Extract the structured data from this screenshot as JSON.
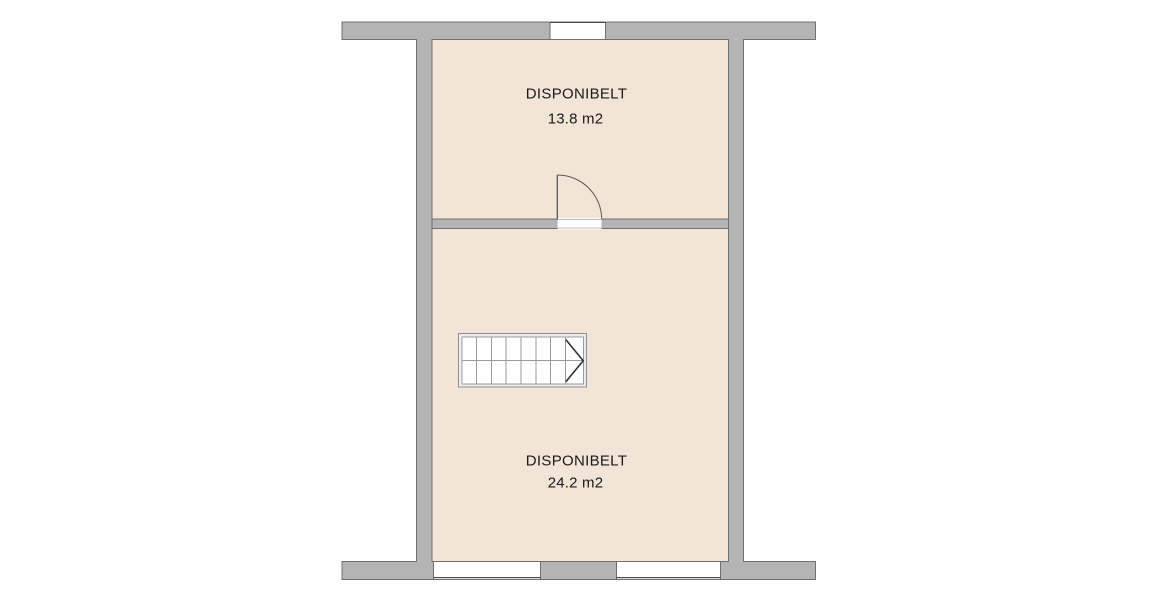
{
  "rooms": [
    {
      "name": "DISPONIBELT",
      "area": "13.8 m2"
    },
    {
      "name": "DISPONIBELT",
      "area": "24.2 m2"
    }
  ],
  "colors": {
    "background": "#ffffff",
    "wall_fill": "#b4b4b4",
    "wall_outline": "#6f6f6f",
    "floor_fill": "#f2e4d7",
    "label_text": "#1a1a1a"
  }
}
